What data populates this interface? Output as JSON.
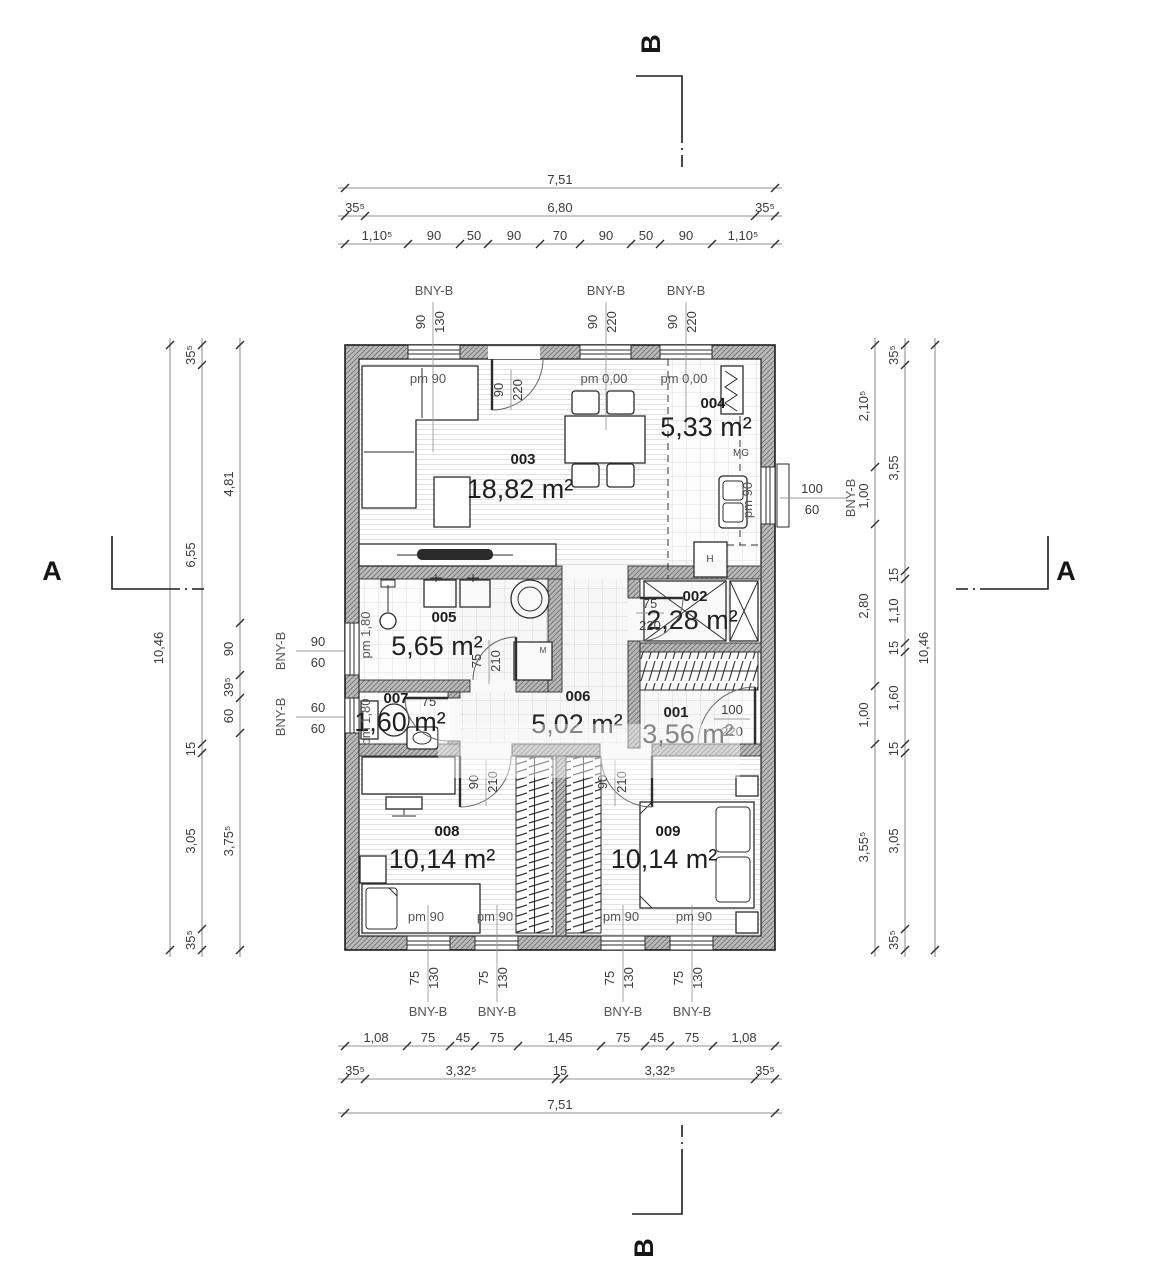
{
  "sections": {
    "a": "A",
    "b": "B"
  },
  "rooms": {
    "r001": {
      "no": "001",
      "area": "3,56 m²"
    },
    "r002": {
      "no": "002",
      "area": "2,28 m²"
    },
    "r003": {
      "no": "003",
      "area": "18,82 m²"
    },
    "r004": {
      "no": "004",
      "area": "5,33 m²"
    },
    "r005": {
      "no": "005",
      "area": "5,65 m²"
    },
    "r006": {
      "no": "006",
      "area": "5,02 m²"
    },
    "r007": {
      "no": "007",
      "area": "1,60 m²"
    },
    "r008": {
      "no": "008",
      "area": "10,14 m²"
    },
    "r009": {
      "no": "009",
      "area": "10,14 m²"
    }
  },
  "fixtures": {
    "mg": "MG",
    "h": "H",
    "m": "M"
  },
  "pm": {
    "pm90": "pm 90",
    "pm000": "pm 0,00",
    "pm180": "pm 1,80"
  },
  "windows": {
    "type": "BNY-B",
    "top": [
      {
        "w": "90",
        "h": "130"
      },
      {
        "w": "90",
        "h": "220"
      },
      {
        "w": "90",
        "h": "220"
      }
    ],
    "bottom": [
      {
        "w": "75",
        "h": "130"
      },
      {
        "w": "75",
        "h": "130"
      },
      {
        "w": "75",
        "h": "130"
      },
      {
        "w": "75",
        "h": "130"
      }
    ],
    "left": [
      {
        "w": "90",
        "h": "60"
      },
      {
        "w": "60",
        "h": "60"
      }
    ],
    "right": [
      {
        "w": "100",
        "h": "60"
      }
    ]
  },
  "doors": {
    "entrance": {
      "w": "90",
      "h": "220"
    },
    "d005": {
      "w": "75",
      "h": "210"
    },
    "d002": {
      "w": "75",
      "h": "220"
    },
    "d001": {
      "w": "100",
      "h": "220"
    },
    "d007": {
      "w": "75"
    },
    "d008": {
      "w": "90",
      "h": "210"
    },
    "d009": {
      "w": "90",
      "h": "210"
    }
  },
  "dims": {
    "top": {
      "total": "7,51",
      "row2": [
        "35⁵",
        "6,80",
        "35⁵"
      ],
      "row3": [
        "1,10⁵",
        "90",
        "50",
        "90",
        "70",
        "90",
        "50",
        "90",
        "1,10⁵"
      ]
    },
    "bottom": {
      "row1": [
        "1,08",
        "75",
        "45",
        "75",
        "1,45",
        "75",
        "45",
        "75",
        "1,08"
      ],
      "row2": [
        "35⁵",
        "3,32⁵",
        "15",
        "3,32⁵",
        "35⁵"
      ],
      "total": "7,51"
    },
    "left": {
      "total": "10,46",
      "chain": [
        "35⁵",
        "6,55",
        "15",
        "3,05",
        "35⁵"
      ],
      "inner": [
        "4,81",
        "90",
        "39⁵",
        "60",
        "3,75⁵"
      ]
    },
    "right": {
      "total": "10,46",
      "chain": [
        "35⁵",
        "3,55",
        "15",
        "1,10",
        "15",
        "1,60",
        "15",
        "3,05",
        "35⁵"
      ],
      "inner": [
        "2,10⁵",
        "1,00",
        "2,80",
        "1,00",
        "3,55⁵"
      ]
    }
  }
}
